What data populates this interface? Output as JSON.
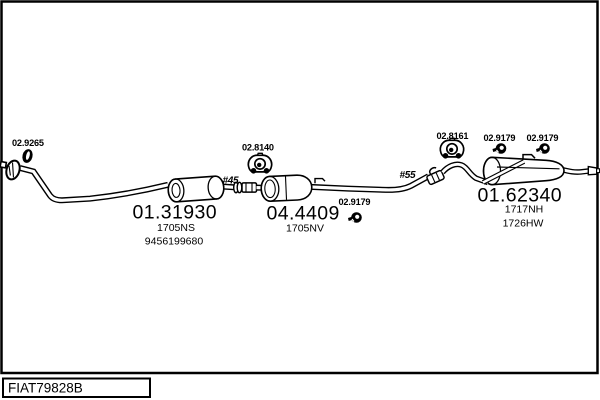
{
  "diagram": {
    "title_box_code": "FIAT79828B",
    "colors": {
      "line": "#000000",
      "background": "#ffffff",
      "text": "#000000"
    },
    "parts": {
      "front_gasket": {
        "label": "02.9265"
      },
      "front_pipe": {
        "code": "01.31930",
        "variant": "1705NS",
        "oem": "9456199680"
      },
      "front_coupling_diameter": "#45",
      "mid_hanger": {
        "label": "02.8140"
      },
      "catalyst": {
        "code": "04.4409",
        "variant": "1705NV"
      },
      "mid_clamp": {
        "label": "02.9179"
      },
      "rear_coupling_diameter": "#55",
      "rear_hanger": {
        "label": "02.8161"
      },
      "rear_clamp_left": {
        "label": "02.9179"
      },
      "rear_clamp_right": {
        "label": "02.9179"
      },
      "rear_muffler": {
        "code": "01.62340",
        "variant_top": "1717NH",
        "variant_bottom": "1726HW"
      }
    }
  }
}
